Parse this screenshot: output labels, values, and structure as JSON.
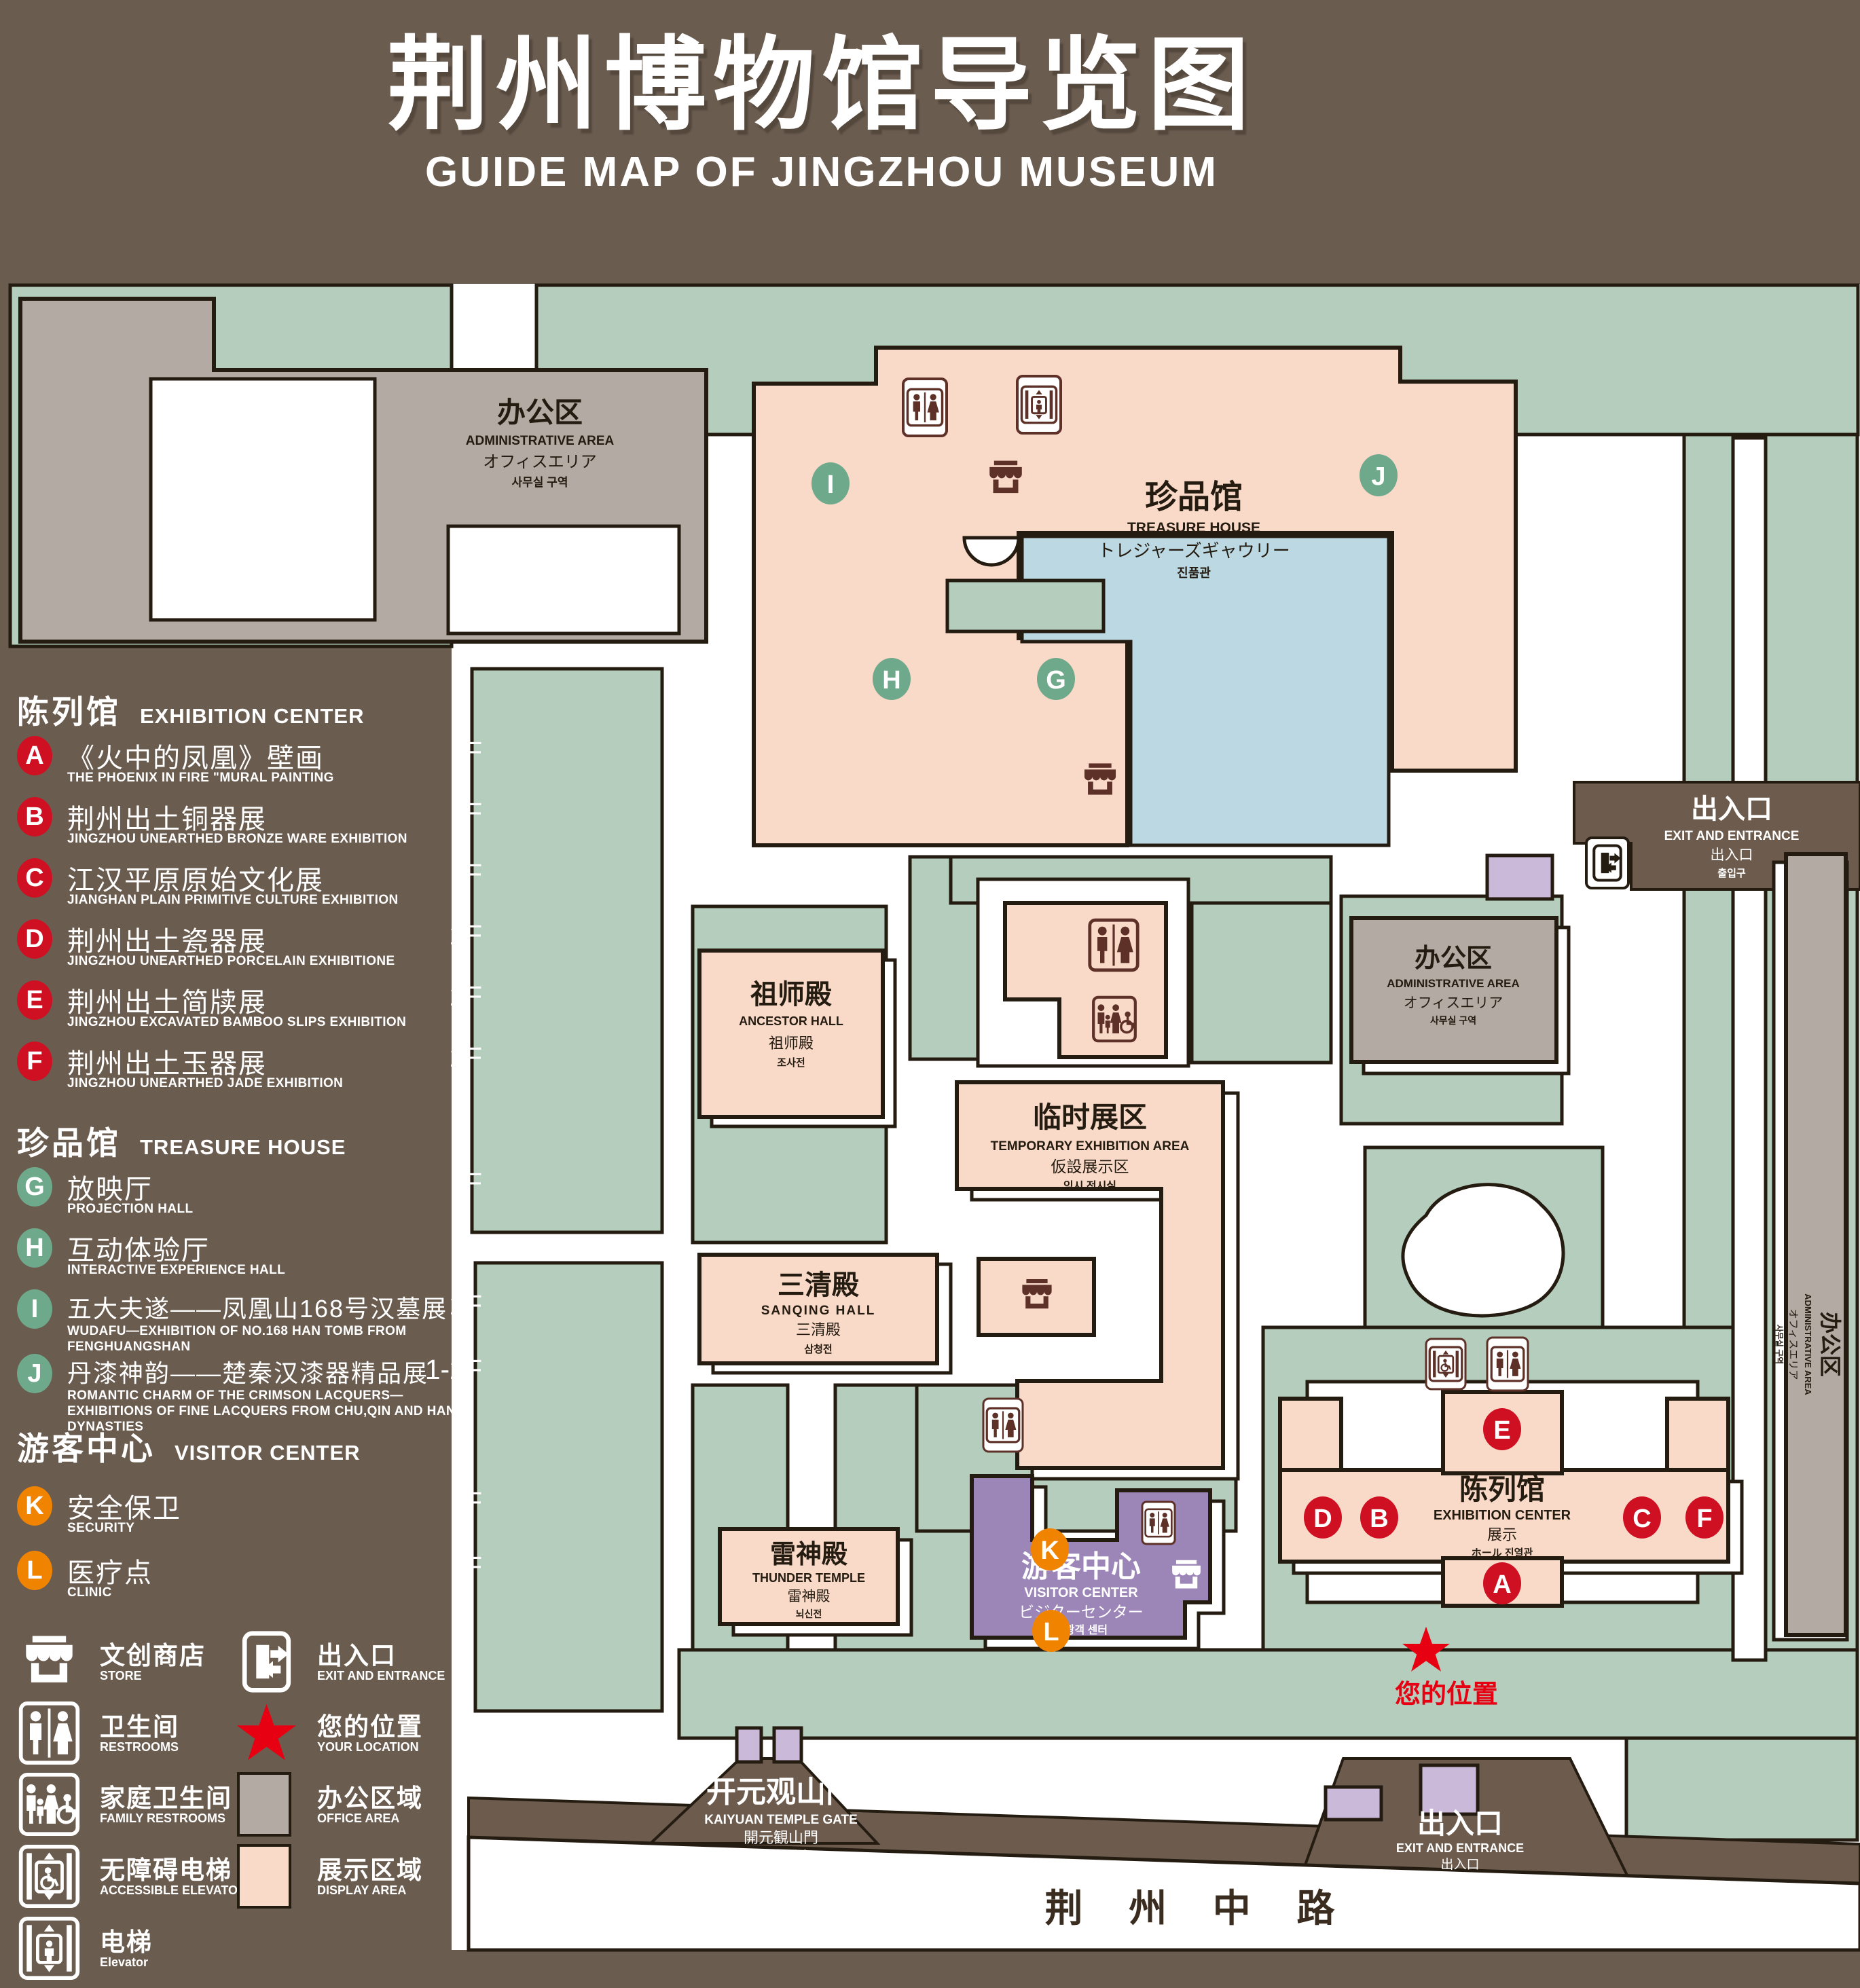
{
  "title": {
    "zh": "荆州博物馆导览图",
    "en": "GUIDE MAP OF JINGZHOU MUSEUM"
  },
  "colors": {
    "background": "#6b5c50",
    "park_green": "#b5cdbc",
    "display_pink": "#f9d9c7",
    "office_gray": "#b3aba3",
    "visitor_purple": "#9c86b8",
    "gate_lavender": "#cbb9da",
    "pond_blue": "#bcd9e3",
    "outline": "#241b11",
    "badge_red": "#cf1022",
    "badge_green": "#6fa98b",
    "badge_orange": "#f08300",
    "star_red": "#e60012",
    "icon_brown": "#5d3028",
    "road_text": "#3a2d20"
  },
  "legend": {
    "sections": [
      {
        "zh": "陈列馆",
        "en": "EXHIBITION CENTER",
        "items": [
          {
            "letter": "A",
            "zh": "《火中的凤凰》壁画",
            "en": "THE PHOENIX IN FIRE \"MURAL PAINTING",
            "floor": "1F"
          },
          {
            "letter": "B",
            "zh": "荆州出土铜器展",
            "en": "JINGZHOU UNEARTHED BRONZE WARE EXHIBITION",
            "floor": "1F"
          },
          {
            "letter": "C",
            "zh": "江汉平原原始文化展",
            "en": "JIANGHAN PLAIN PRIMITIVE CULTURE EXHIBITION",
            "floor": "1F"
          },
          {
            "letter": "D",
            "zh": "荆州出土瓷器展",
            "en": "JINGZHOU UNEARTHED PORCELAIN EXHIBITIONE",
            "floor": "2F"
          },
          {
            "letter": "E",
            "zh": "荆州出土简牍展",
            "en": "JINGZHOU EXCAVATED BAMBOO SLIPS EXHIBITION",
            "floor": "2F"
          },
          {
            "letter": "F",
            "zh": "荆州出土玉器展",
            "en": "JINGZHOU UNEARTHED JADE EXHIBITION",
            "floor": "2F"
          }
        ]
      },
      {
        "zh": "珍品馆",
        "en": "TREASURE HOUSE",
        "items": [
          {
            "letter": "G",
            "zh": "放映厅",
            "en": "PROJECTION HALL",
            "floor": "1F"
          },
          {
            "letter": "H",
            "zh": "互动体验厅",
            "en": "INTERACTIVE EXPERIENCE HALL",
            "floor": "1F"
          },
          {
            "letter": "I",
            "zh": "五大夫遂——凤凰山168号汉墓展",
            "en": "WUDAFU—EXHIBITION OF NO.168 HAN TOMB FROM FENGHUANGSHAN",
            "floor": "2F"
          },
          {
            "letter": "J",
            "zh": "丹漆神韵——楚秦汉漆器精品展",
            "en": "ROMANTIC CHARM OF THE CRIMSON LACQUERS—EXHIBITIONS OF FINE LACQUERS FROM CHU,QIN AND HAN DYNASTIES",
            "floor": "1-2F"
          }
        ]
      },
      {
        "zh": "游客中心",
        "en": "VISITOR CENTER",
        "items": [
          {
            "letter": "K",
            "zh": "安全保卫",
            "en": "SECURITY",
            "floor": "1F"
          },
          {
            "letter": "L",
            "zh": "医疗点",
            "en": "CLINIC",
            "floor": "1F"
          }
        ]
      }
    ],
    "symbols": [
      {
        "icon": "store-icon",
        "zh": "文创商店",
        "en": "STORE"
      },
      {
        "icon": "exit-icon",
        "zh": "出入口",
        "en": "EXIT AND ENTRANCE"
      },
      {
        "icon": "restroom-icon",
        "zh": "卫生间",
        "en": "RESTROOMS"
      },
      {
        "icon": "location-star-icon",
        "zh": "您的位置",
        "en": "YOUR LOCATION"
      },
      {
        "icon": "family-restroom-icon",
        "zh": "家庭卫生间",
        "en": "FAMILY RESTROOMS"
      },
      {
        "icon": "office-area-swatch",
        "zh": "办公区域",
        "en": "OFFICE AREA"
      },
      {
        "icon": "accessible-elevator-icon",
        "zh": "无障碍电梯",
        "en": "ACCESSIBLE ELEVATOR"
      },
      {
        "icon": "display-area-swatch",
        "zh": "展示区域",
        "en": "DISPLAY AREA"
      },
      {
        "icon": "elevator-icon",
        "zh": "电梯",
        "en": "Elevator"
      }
    ]
  },
  "map": {
    "admin_tl": {
      "zh": "办公区",
      "en": "ADMINISTRATIVE AREA",
      "jp": "オフィスエリア",
      "kr": "사무실 구역"
    },
    "treasure": {
      "zh": "珍品馆",
      "en": "TREASURE HOUSE",
      "jp": "トレジャーズギャウリー",
      "kr": "진품관"
    },
    "ancestor": {
      "zh": "祖师殿",
      "en": "ANCESTOR HALL",
      "jp": "祖师殿",
      "kr": "조사전"
    },
    "temporary": {
      "zh": "临时展区",
      "en": "TEMPORARY EXHIBITION AREA",
      "jp": "仮設展示区",
      "kr": "임시 전시실"
    },
    "admin_mid": {
      "zh": "办公区",
      "en": "ADMINISTRATIVE AREA",
      "jp": "オフィスエリア",
      "kr": "사무실 구역"
    },
    "admin_right": {
      "zh": "办公区",
      "en": "ADMINISTRATIVE AREA",
      "jp": "オフィスエリア",
      "kr": "사무실 구역"
    },
    "sanqing": {
      "zh": "三清殿",
      "en": "SANQING HALL",
      "jp": "三清殿",
      "kr": "삼청전"
    },
    "thunder": {
      "zh": "雷神殿",
      "en": "THUNDER TEMPLE",
      "jp": "雷神殿",
      "kr": "뇌신전"
    },
    "visitor": {
      "zh": "游客中心",
      "en": "VISITOR CENTER",
      "jp": "ビジターセンター",
      "kr": "관광객 센터"
    },
    "exhibition": {
      "zh": "陈列馆",
      "en": "EXHIBITION CENTER",
      "line3": "展示",
      "line4": "ホール 진열관"
    },
    "gate": {
      "zh": "开元观山门",
      "en": "KAIYUAN TEMPLE GATE",
      "jp": "開元観山門",
      "kr": "산문을 열다"
    },
    "exit_top": {
      "zh": "出入口",
      "en": "EXIT AND ENTRANCE",
      "jp": "出入口",
      "kr": "출입구"
    },
    "exit_bottom": {
      "zh": "出入口",
      "en": "EXIT AND ENTRANCE",
      "jp": "出入口",
      "kr": "출입구"
    },
    "road": "荆 州 中 路",
    "your_location": "您的位置",
    "badges": {
      "A": "A",
      "B": "B",
      "C": "C",
      "D": "D",
      "E": "E",
      "F": "F",
      "G": "G",
      "H": "H",
      "I": "I",
      "J": "J",
      "K": "K",
      "L": "L"
    }
  }
}
